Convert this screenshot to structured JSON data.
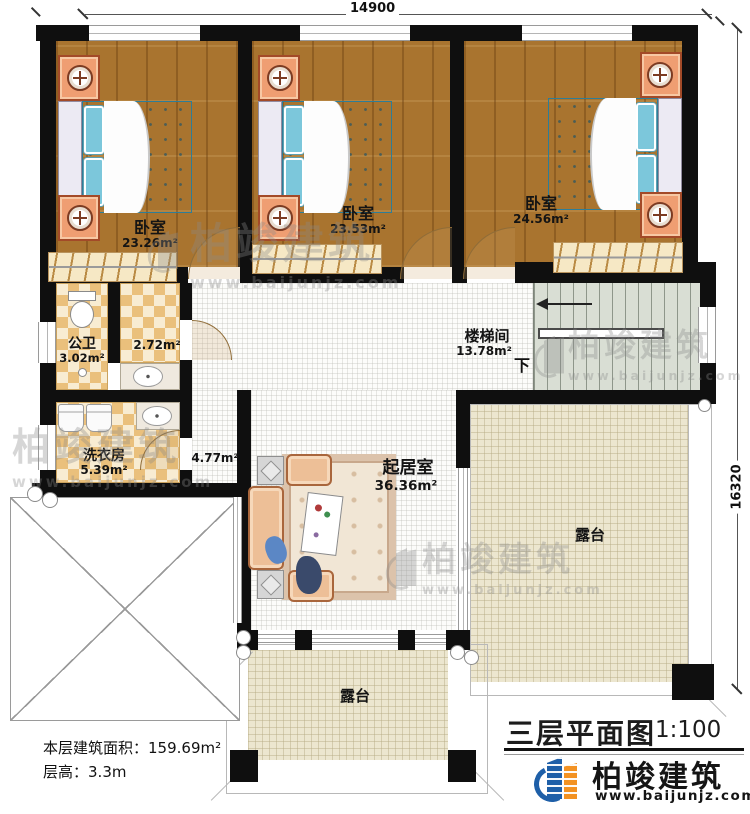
{
  "dimensions": {
    "top": "14900",
    "right": "16320"
  },
  "rooms": {
    "bedroom1": {
      "name": "卧室",
      "area": "23.26m²"
    },
    "bedroom2": {
      "name": "卧室",
      "area": "23.53m²"
    },
    "bedroom3": {
      "name": "卧室",
      "area": "24.56m²"
    },
    "bathroom": {
      "name": "公卫",
      "area": "3.02m²"
    },
    "vanity": {
      "area": "2.72m²"
    },
    "laundry": {
      "name": "洗衣房",
      "area": "5.39m²"
    },
    "corridor": {
      "area": "4.77m²"
    },
    "stairwell": {
      "name": "楼梯间",
      "area": "13.78m²",
      "direction": "下"
    },
    "living": {
      "name": "起居室",
      "area": "36.36m²"
    },
    "terrace_right": {
      "name": "露台"
    },
    "terrace_bottom": {
      "name": "露台"
    }
  },
  "footer": {
    "floor_area_label": "本层建筑面积：",
    "floor_area_value": "159.69m²",
    "floor_height_label": "层高：",
    "floor_height_value": "3.3m"
  },
  "title": {
    "text": "三层平面图",
    "scale": "1:100"
  },
  "brand": {
    "name": "柏竣建筑",
    "website": "www.baijunjz.com"
  },
  "watermark": {
    "name": "柏竣建筑",
    "website": "www.baijunjz.com"
  },
  "colors": {
    "wall": "#0f0f0f",
    "wood": "#a9742f",
    "tile_a": "#eac07c",
    "tile_b": "#f8ecd2",
    "terrace": "#ece6cf",
    "bed": "#5fb6cf",
    "brand_blue": "#1e5fa8",
    "brand_orange": "#f39222",
    "wm": "#8a8a8a"
  }
}
